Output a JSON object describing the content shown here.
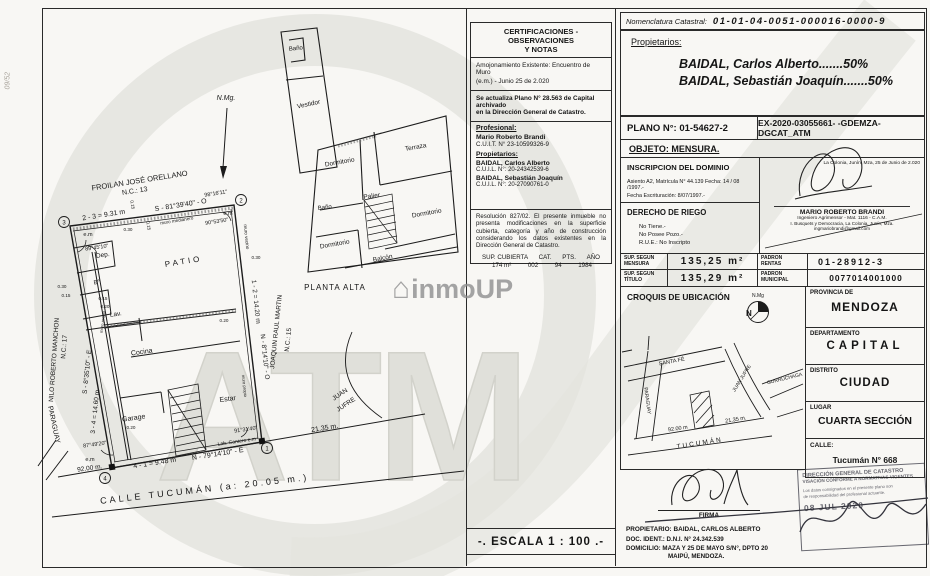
{
  "sheet": {
    "margin_note": "09/52",
    "watermark_atm": "ATM",
    "watermark_house": "⌂",
    "watermark_inmoup": "inmoUP"
  },
  "plan": {
    "north_label": "N.Mg.",
    "planta_alta": {
      "caption": "PLANTA ALTA",
      "rooms": {
        "banio_top": "Baño",
        "vestidor": "Vestidor",
        "dormitorio_nw": "Dormitorio",
        "terraza": "Terraza",
        "palier": "Palier",
        "banio_mid": "Baño",
        "dormitorio_e": "Dormitorio",
        "dormitorio_sw": "Dormitorio",
        "balcon": "Balcón"
      }
    },
    "planta_baja": {
      "rooms": {
        "patio": "PATIO",
        "dep": "Dep.",
        "bano": "B°",
        "lav": "Lav.",
        "cocina": "Cocina",
        "estar": "Estar",
        "garage": "Garage"
      },
      "vertices": [
        "1",
        "2",
        "3",
        "4"
      ],
      "sides": {
        "top_len": "2 - 3 = 9.31 m",
        "top_bearing": "S - 81°39'40\" - O",
        "right_len": "1 - 2 = 14.20 m",
        "right_bearing": "N - 8°14'10\" - O",
        "left_len": "3 - 4 = 14.60 m",
        "left_bearing": "S - 8°35'10\" - E",
        "bottom_len": "4 - 1 = 9.48 m",
        "bottom_bearing": "N - 79°14'10\" - E"
      },
      "angles": {
        "v1": "91°31'40\"",
        "v2_a": "98°16'11\"",
        "v2_b": "90°53'50\"",
        "v3": "89°45'10\"",
        "v4": "87°49'20\""
      },
      "walls": {
        "medianero": "muro medianero",
        "vecino": "muro vecino",
        "propio": "muro propio"
      },
      "em": "e.m",
      "cantero": "Lab. Cantero e.m",
      "dims": [
        "0.30",
        "0.15",
        "0.15",
        "0.30",
        "0.15",
        "0.15",
        "0.20",
        "0.20",
        "0.30",
        "0.20"
      ],
      "neighbors": {
        "top1": "FROILAN JOSÉ ORELLANO",
        "top2": "N.C.: 13",
        "left1": "NILO ROBERTO MANCHON",
        "left2": "N.C.: 17",
        "right1": "JOAQUIN RAUL MARTIN",
        "right2": "N.C.: 15"
      },
      "streets": {
        "tucuman": "CALLE TUCUMÁN (a: 20.05 m.)",
        "paraguay": "PARAGUAY",
        "juan_jufre1": "JUAN",
        "juan_jufre2": "JUFRE",
        "width_left": "92.00 m.",
        "len_right": "21.35 m."
      }
    }
  },
  "notes": {
    "title1": "CERTIFICACIONES - OBSERVACIONES",
    "title2": "Y NOTAS",
    "note1a": "Amojonamiento Existente: Encuentro de Muro",
    "note1b": "(e.m.)  -  Junio 25 de 2.020",
    "note2a": "Se actualiza Plano N° 28.563 de Capital archivado",
    "note2b": "en la Dirección General de Catastro.",
    "prof_label": "Profesional:",
    "prof_name": "Mario Roberto Brandi",
    "prof_cuit": "C.U.I.T. N° 23-10599326-9",
    "owners_label": "Propietarios:",
    "owner1_name": "BAIDAL, Carlos Alberto",
    "owner1_cuil": "C.U.I.L. N°: 20-24342539-6",
    "owner2_name": "BAIDAL, Sebastián Joaquín",
    "owner2_cuil": "C.U.I.L. N°: 20-27090761-0",
    "resolution": "Resolución 827/02. El presente inmueble no presenta modificaciones en la superficie cubierta, categoría y año de construcción considerando los datos existentes en la Dirección General de Catastro.",
    "table": {
      "h1": "SUP. CUBIERTA",
      "h2": "CAT.",
      "h3": "PTS.",
      "h4": "AÑO",
      "v1": "174 m²",
      "v2": "002",
      "v3": "94",
      "v4": "1984"
    },
    "escala": "-. ESCALA 1 : 100 .-"
  },
  "panel": {
    "nomenclatura_label": "Nomenclatura Catastral:",
    "nomenclatura_value": "01-01-04-0051-000016-0000-9",
    "owners_label": "Propietarios:",
    "owner1": "BAIDAL, Carlos Alberto.......50%",
    "owner2": "BAIDAL, Sebastián Joaquín.......50%",
    "plano": "PLANO N°: 01-54627-2",
    "expediente": "EX-2020-03055661- -GDEMZA-DGCAT_ATM",
    "objeto": "OBJETO: MENSURA.",
    "inscripcion_title": "INSCRIPCION DEL DOMINIO",
    "inscripcion_l1": "Asiento A2, Matrícula N° 44.139 Fecha: 14 / 08 /1997.-",
    "inscripcion_l2": "Fecha Escrituración: 8/07/1997.-",
    "place_date": "La Colonia, Junín, Mza, 25 de Junio de 2.020",
    "surveyor_name": "MARIO ROBERTO BRANDI",
    "surveyor_l1": "Ingeniero Agrimensor  -  Mat. 1116 - C.A.M.",
    "surveyor_l2": "I. Busquets y Democracia, La Colonia, Junín, Mza.",
    "surveyor_email": "ingmariobrandi@gmail.com",
    "riego_title": "DERECHO DE RIEGO",
    "riego_l1": "No Tiene.-",
    "riego_l2": "No Posee Pozo.-",
    "riego_l3": "R.U.E.: No Inscripto",
    "sup_mensura_label1": "SUP. SEGUN",
    "sup_mensura_label2": "MENSURA",
    "sup_mensura_value": "135,25 m²",
    "padron_rentas_label1": "PADRON",
    "padron_rentas_label2": "RENTAS",
    "padron_rentas_value": "01-28912-3",
    "sup_titulo_label1": "SUP. SEGUN",
    "sup_titulo_label2": "TÍTULO",
    "sup_titulo_value": "135,29 m²",
    "padron_municipal_label1": "PADRON",
    "padron_municipal_label2": "MUNICIPAL",
    "padron_municipal_value": "0077014001000",
    "croquis_title": "CROQUIS DE UBICACIÓN",
    "croquis": {
      "north_small": "N.Mg",
      "north_n": "N",
      "santa_fe": "SANTA FÉ",
      "paraguay": "PARAGUAY",
      "tucuman": "TUCUMÁN",
      "juan_jufre": "JUAN JUFRE",
      "gurruchaga": "GURRUCHAGA",
      "dim_left": "92.00 m",
      "dim_right": "21.35 m."
    },
    "location": {
      "provincia_label": "PROVINCIA DE",
      "provincia": "MENDOZA",
      "departamento_label": "DEPARTAMENTO",
      "departamento": "CAPITAL",
      "distrito_label": "DISTRITO",
      "distrito": "CIUDAD",
      "lugar_label": "LUGAR",
      "lugar": "CUARTA SECCIÓN",
      "calle_label": "CALLE:",
      "calle": "Tucumán N° 668"
    },
    "firma_label": "FIRMA",
    "prop_l1": "PROPIETARIO: BAIDAL, CARLOS ALBERTO",
    "prop_l2": "DOC. IDENT.: D.N.I. N° 24.342.539",
    "prop_l3": "DOMICILIO: MAZA Y 25 DE MAYO S/N°, DPTO 20",
    "prop_l4": "MAIPÚ, MENDOZA.",
    "stamp": {
      "l1": "DIRECCIÓN GENERAL DE CATASTRO",
      "l2": "VISACIÓN CONFORME A NORMATIVAS VIGENTES",
      "l3": "Los datos consignados en el presente plano son",
      "l4": "de responsabilidad del profesional actuante.",
      "date": "08 JUL 2020"
    }
  }
}
